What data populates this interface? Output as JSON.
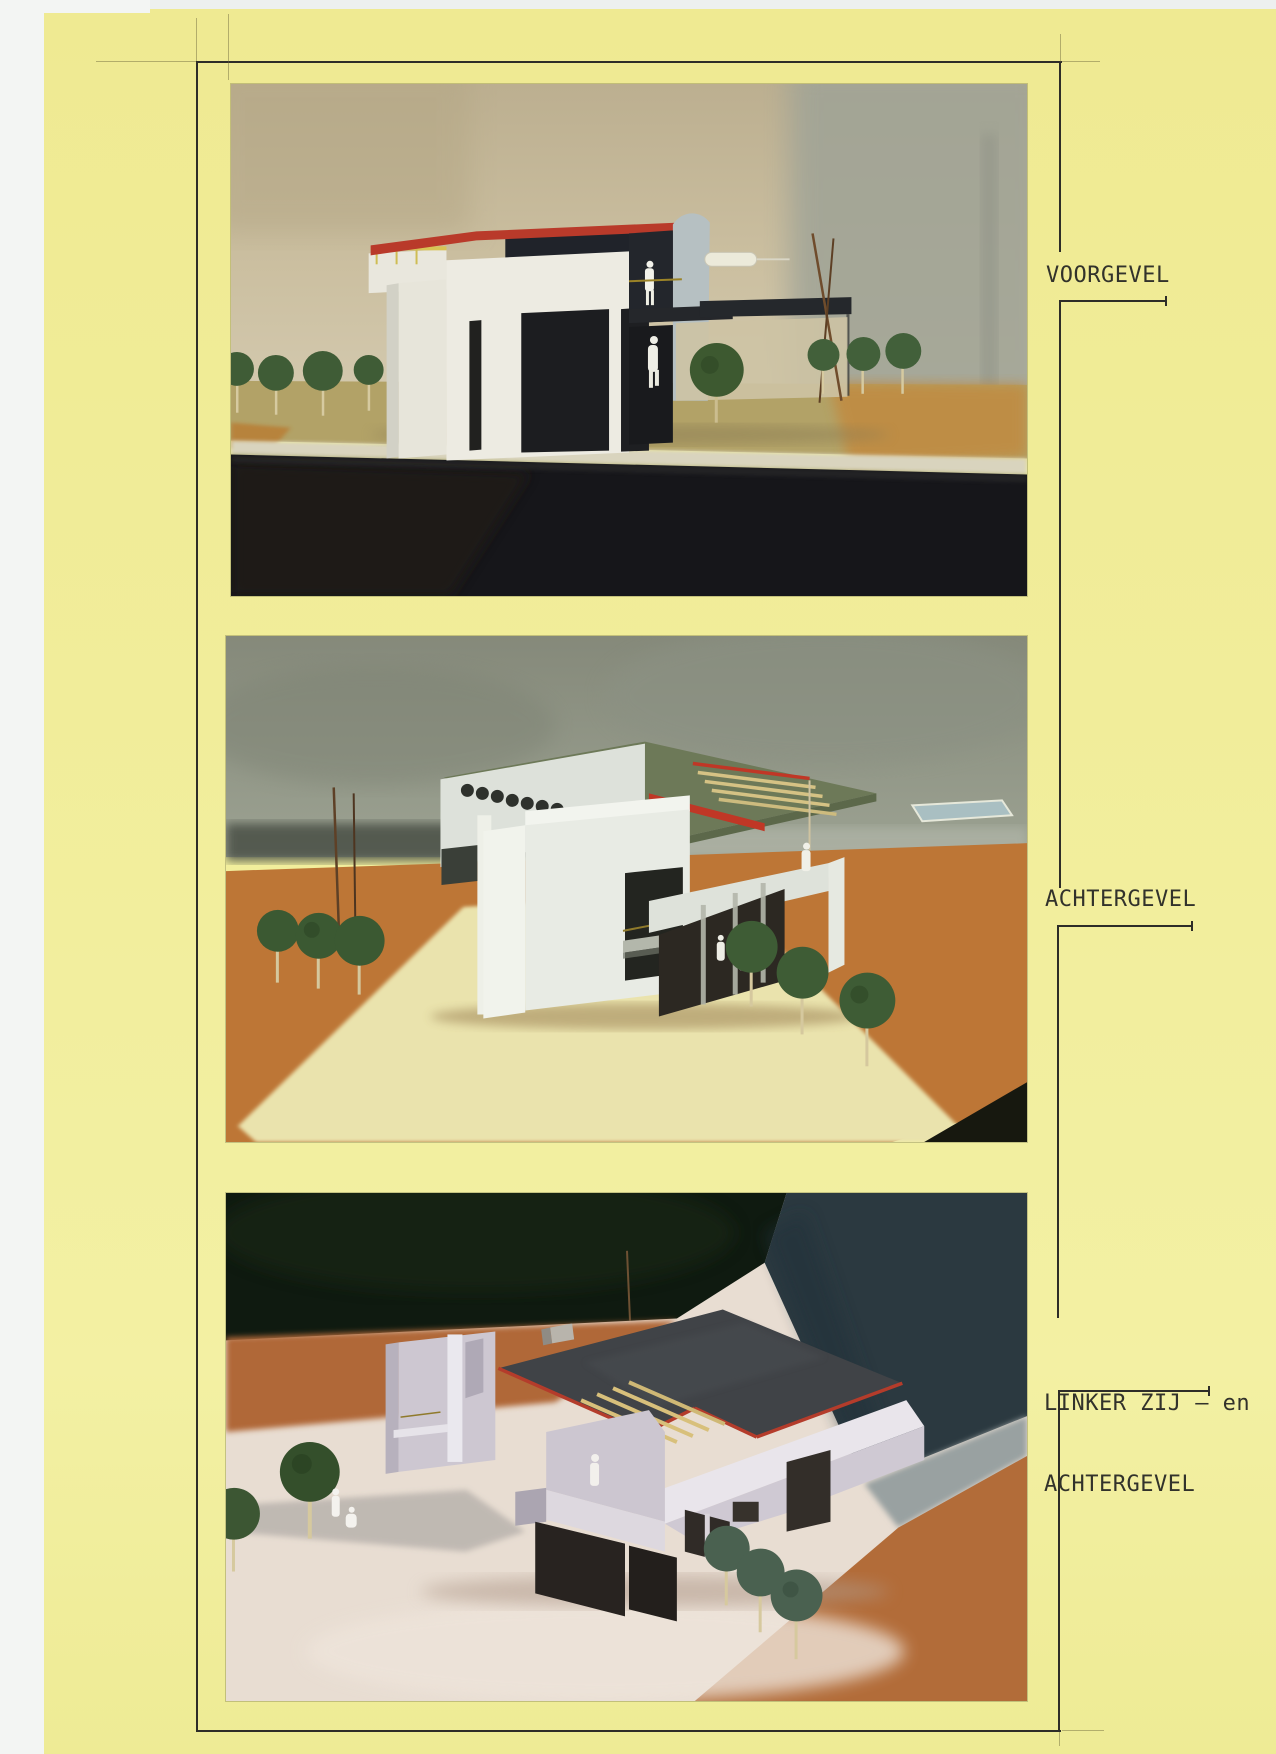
{
  "page": {
    "background_color": "#f0ec97",
    "scan_margin_color": "#f3f5f3",
    "frame_color": "#2e2d28",
    "label_text_color": "#32322b"
  },
  "figures": [
    {
      "id": "voorgevel",
      "label": "VOORGEVEL",
      "description": "Photo of architectural scale model, front facade: white modernist volumes, red flat-roof band, grey curved end wall, dark canopy, miniature trees and white figures on a khaki tabletop with dark foreground"
    },
    {
      "id": "achtergevel",
      "label": "ACHTERGEVEL",
      "description": "Photo of architectural scale model, rear facade: sage-green flat roof, wall with round portholes, yellow pergola beams with red edge, white volumes, terracotta base board with cream terrace and rows of miniature trees"
    },
    {
      "id": "linker-zij-en-achtergevel",
      "label_line1": "LINKER ZIJ – en",
      "label_line2": "ACHTERGEVEL",
      "description": "Photo of architectural scale model seen from above, left side and rear facade: charcoal flat roof with red trim, yellow pergola, pale lilac walls, dark window bands, pink ground plane with terracotta road and miniature trees and figures"
    }
  ],
  "accent_colors": {
    "roof_red": "#b93a2a",
    "pergola_yellow": "#d8c455",
    "tree_green": "#3d5930",
    "terracotta": "#bd7636",
    "table_khaki": "#b2a267",
    "roof_green": "#6d7958",
    "roof_charcoal": "#404347",
    "ground_pink": "#e8ddd2",
    "ground_cream": "#eae3ad",
    "end_wall_grey": "#b6c0c2"
  }
}
